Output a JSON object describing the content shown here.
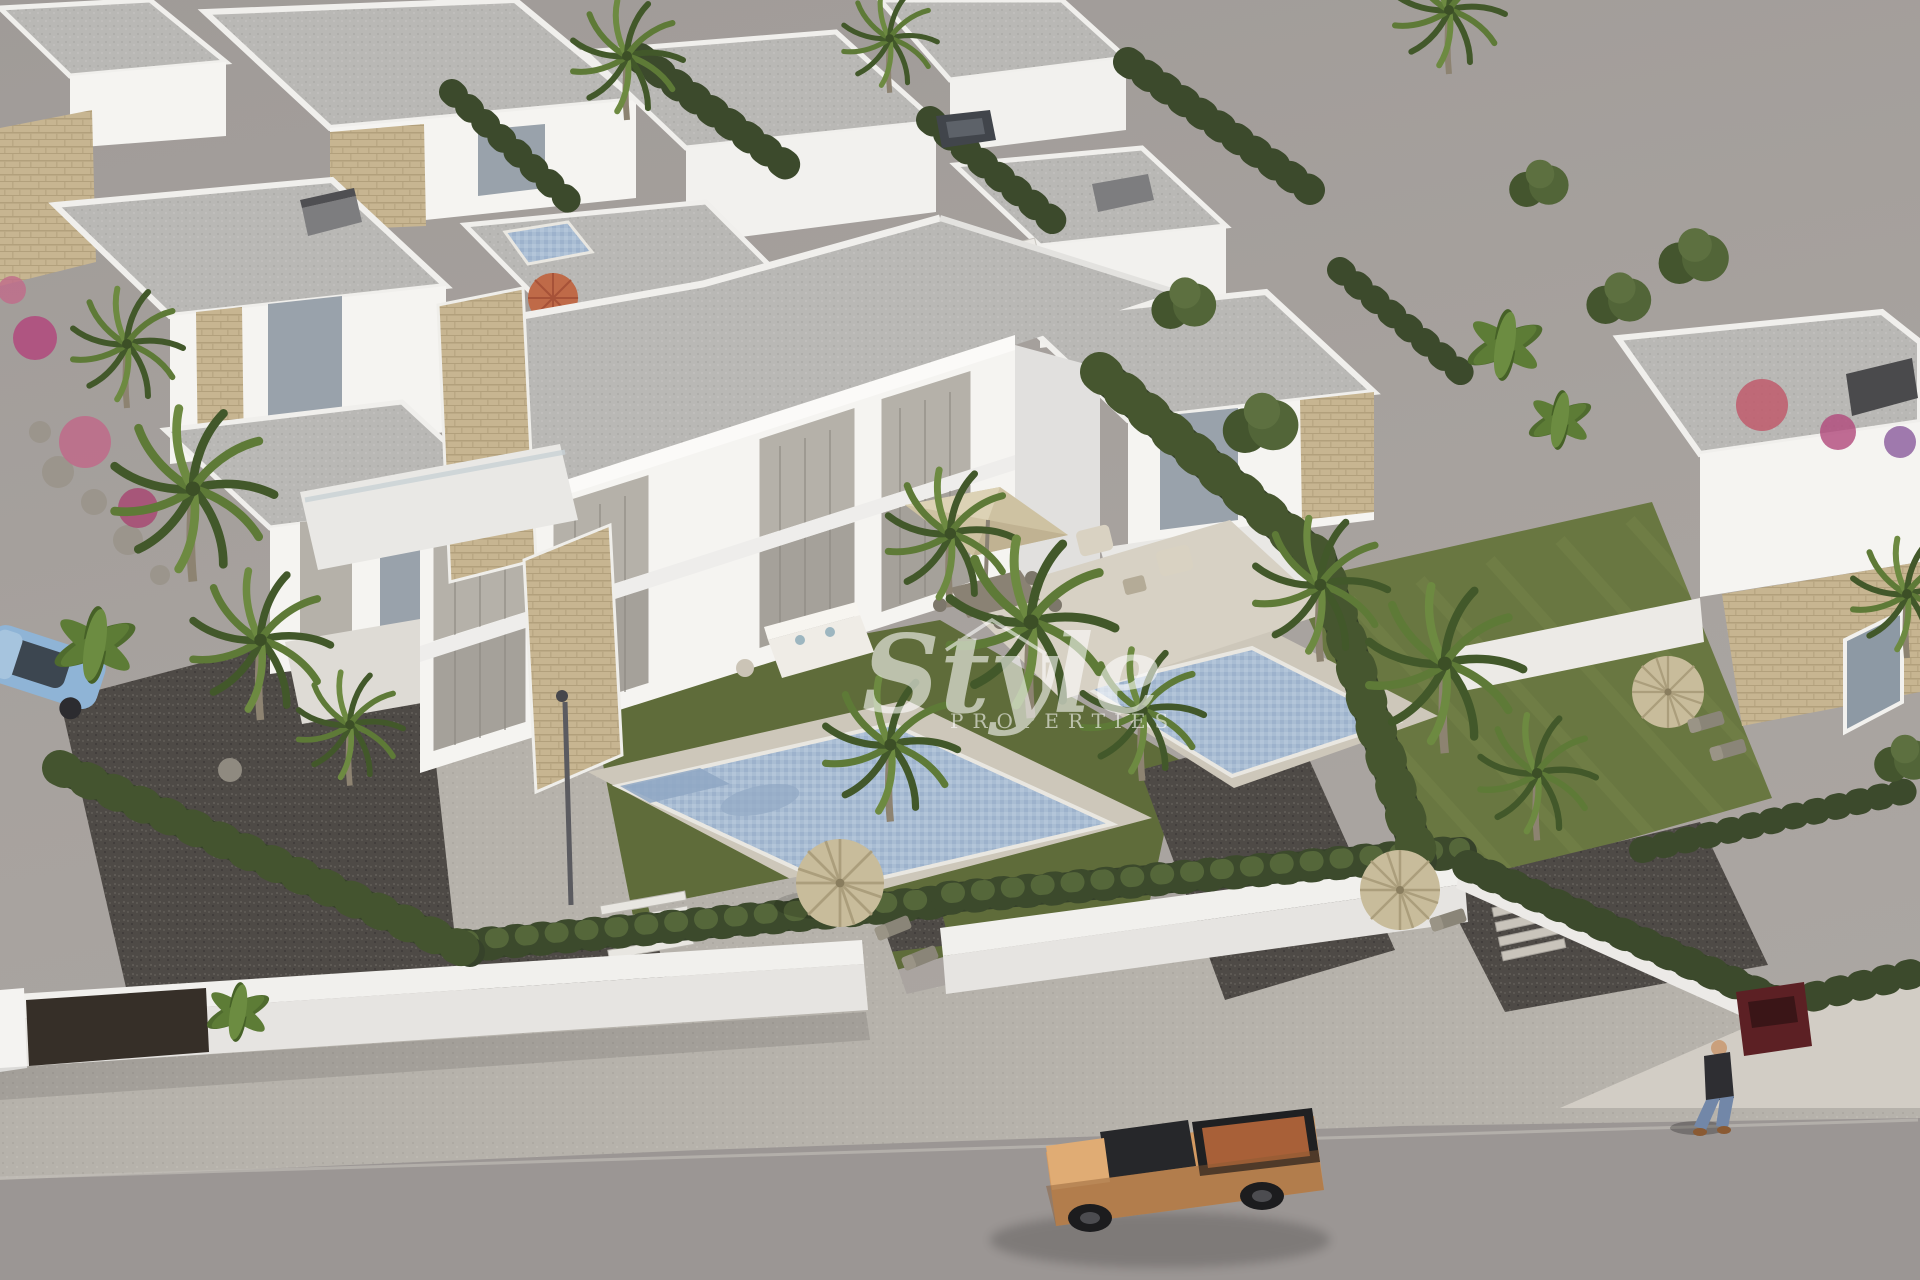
{
  "watermark": {
    "script": "Style",
    "caps": "PROPERTIES",
    "color": "#ffffff",
    "opacity": 0.58
  },
  "scene": {
    "type": "3d-aerial-architectural-render",
    "subject": "new-build white villas development with private pools, gardens, palm trees, street with pickup truck and pedestrian"
  },
  "palette": {
    "backdrop": "#a7a29e",
    "backdrop_top": "#a09b98",
    "road": "#9b9694",
    "sidewalk": "#b6b2ab",
    "pavement_bright": "#d2cdc5",
    "wall_white": "#f1f0ed",
    "wall_face": "#e6e4e1",
    "gate_dark": "#362f28",
    "roof_gray": "#b9b8b5",
    "facade_white": "#f5f4f1",
    "facade_shade": "#e1e0de",
    "stone": "#c7b591",
    "glass": "#99a2ab",
    "curtain": "#b5b1a9",
    "grass": "#5f6c3a",
    "grass_right": "#697741",
    "hedge_dark": "#3c4a2c",
    "hedge_light": "#55673a",
    "gravel": "#4e4a46",
    "pool_water": "#a9bdd3",
    "pool_water_dark": "#8fa7c3",
    "pool_deck": "#cdc7ba",
    "thatch": "#c8bc9b",
    "parasol_orange": "#bf6a48",
    "parasol_beige": "#cec2a2",
    "truck_body": "#d39a62",
    "truck_bed": "#a86038",
    "car_blue": "#8fb4d6",
    "car_red": "#5c2024",
    "palm_green": "#5e7a37",
    "palm_dark": "#42582a",
    "trunk": "#8d8371",
    "lamp_gray": "#5b5b60",
    "person_jacket": "#2e2e32",
    "person_jeans": "#7287a8"
  }
}
